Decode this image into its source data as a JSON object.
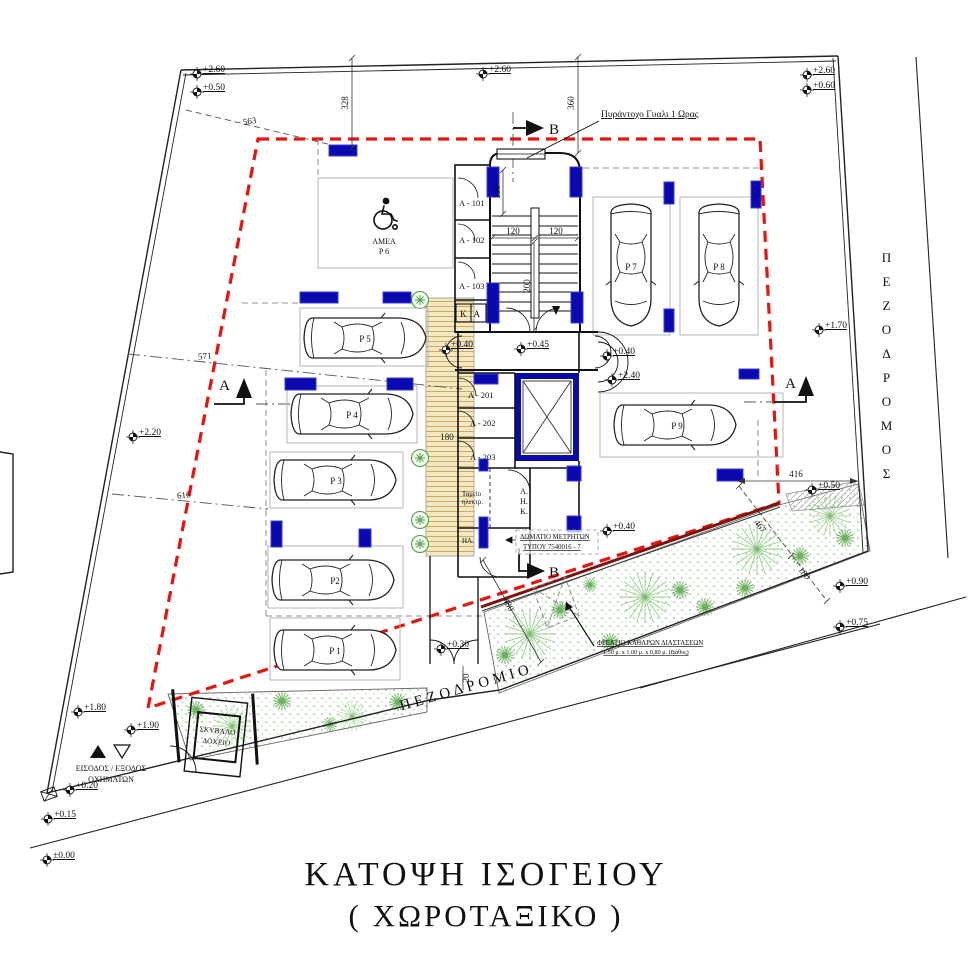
{
  "title": {
    "line1": "ΚΑΤΟΨΗ ΙΣΟΓΕΙΟΥ",
    "line2": "( ΧΩΡΟΤΑΞΙΚΟ )"
  },
  "streets": {
    "right": "ΠΕΖΟΔΡΟΜΟΣ",
    "bottom": "ΠΕΖΟΔΡΟΜΙΟ"
  },
  "levels": {
    "tl1": "+2.60",
    "tl2": "+0.50",
    "tc": "+2.60",
    "tr1": "+2.60",
    "tr2": "+0.60",
    "right": "+1.70",
    "walkway": "+0.40",
    "lobby": "+0.45",
    "court1": "+0.40",
    "court2": "+2.40",
    "court3": "+0.40",
    "se": "+0.50",
    "se2": "+0.90",
    "se3": "+0.75",
    "left": "+2.20",
    "bl1": "+1.80",
    "bl2": "+1.90",
    "bl3": "+0.20",
    "bl4": "+0.15",
    "bl5": "±0.00",
    "gate": "+0.30"
  },
  "dims": {
    "d563": "563",
    "d328": "328",
    "d360": "360",
    "d571": "571",
    "d616": "616",
    "d150": "150",
    "d120a": "120",
    "d120b": "120",
    "d200": "200",
    "d180w": "180",
    "d480": "480",
    "d20": "20",
    "d416": "416",
    "d467": "467",
    "d180e": "180"
  },
  "cars": {
    "p1": "P 1",
    "p2": "P2",
    "p3": "P 3",
    "p4": "P 4",
    "p5": "P 5",
    "p7": "P 7",
    "p8": "P 8",
    "p9": "P 9"
  },
  "amea": {
    "line1": "ΑΜΕΑ",
    "line2": "P 6"
  },
  "rooms": {
    "a101": "Α - 101",
    "a102": "Α - 102",
    "a103": "Α - 103",
    "a201": "Α - 201",
    "a202": "Α - 202",
    "a203": "Α - 203",
    "ka": "ΚΑ",
    "hl": "ΗΛ.",
    "ahk1": "Α.",
    "ahk2": "Η.",
    "ahk3": "Κ.",
    "board1": "Ταμείο",
    "board2": "ηλεκτρ."
  },
  "notes": {
    "fireglass": "Πυράντοχο Γυαλι 1 Ωρας",
    "meter1": "ΔΩΜΑΤΙΟ ΜΕΤΡΗΤΩΝ",
    "meter2": "ΤΥΠΟΥ 7540016 - 7",
    "manhole1": "ΦΡΕΑΤΙΟ ΚΑΘΑΡΩΝ ΔΙΑΣΤΑΣΕΩΝ",
    "manhole2": "1,50 μ. x 1.00 μ. x 0,80 μ. (Βάθος)",
    "access1": "ΕΙΣΟΔΟΣ / ΕΞΟΔΟΣ",
    "access2": "ΟΧΗΜΑΤΩΝ",
    "garbage1": "ΣΚΥΒΑΛΟ",
    "garbage2": "ΔΟΧΕΙΟ"
  },
  "sections": {
    "a": "A",
    "b": "B"
  },
  "colors": {
    "setback_red": "#e8150e",
    "column_blue": "#0909ad",
    "plant_green": "#6ab05e",
    "walkway_tan": "#f3e8c2"
  }
}
